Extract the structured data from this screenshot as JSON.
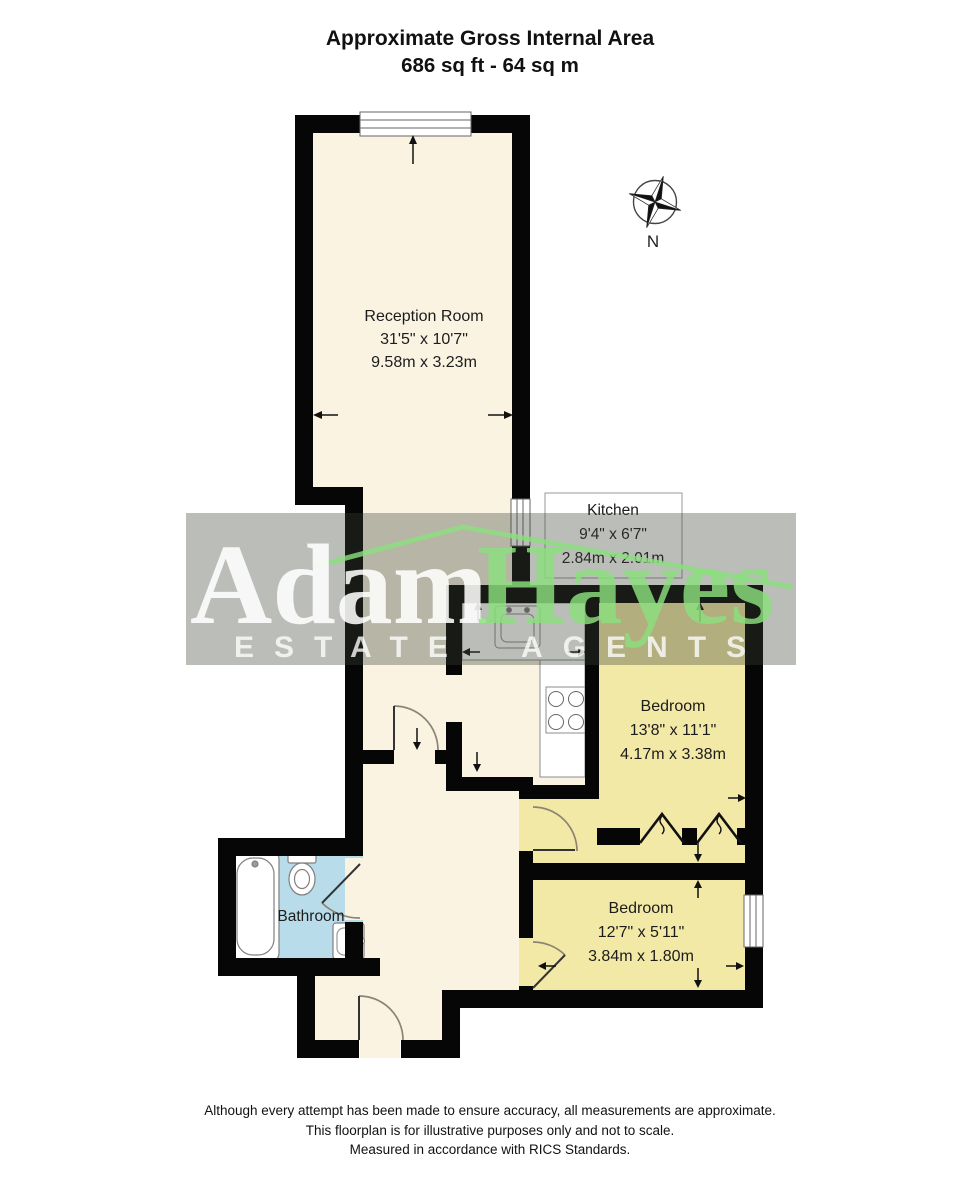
{
  "title": {
    "line1": "Approximate Gross Internal Area",
    "line2": "686 sq ft - 64 sq m"
  },
  "compass": {
    "north_label": "N"
  },
  "rooms": {
    "reception": {
      "name": "Reception Room",
      "size_imperial": "31'5\" x 10'7\"",
      "size_metric": "9.58m x 3.23m"
    },
    "kitchen": {
      "name": "Kitchen",
      "size_imperial": "9'4\" x 6'7\"",
      "size_metric": "2.84m x 2.01m"
    },
    "bedroom1": {
      "name": "Bedroom",
      "size_imperial": "13'8\" x 11'1\"",
      "size_metric": "4.17m x 3.38m"
    },
    "bedroom2": {
      "name": "Bedroom",
      "size_imperial": "12'7\" x 5'11\"",
      "size_metric": "3.84m x 1.80m"
    },
    "bathroom": {
      "name": "Bathroom"
    }
  },
  "watermark": {
    "brand_word1": "Adam",
    "brand_word2": "Hayes",
    "tagline": "ESTATE AGENTS"
  },
  "footer": {
    "line1": "Although every attempt has been made to ensure accuracy, all measurements are approximate.",
    "line2": "This floorplan is for illustrative purposes only and not to scale.",
    "line3": "Measured in accordance with RICS Standards."
  },
  "colors": {
    "wall": "#060606",
    "floor_cream": "#FAF3E2",
    "bedroom_yellow": "#F3E9A6",
    "bathroom_blue": "#B8DCE9",
    "watermark_green": "#8BE07E",
    "watermark_band": "rgba(58,66,52,0.35)",
    "watermark_text": "rgba(255,255,255,0.87)",
    "arrow": "#111111"
  }
}
